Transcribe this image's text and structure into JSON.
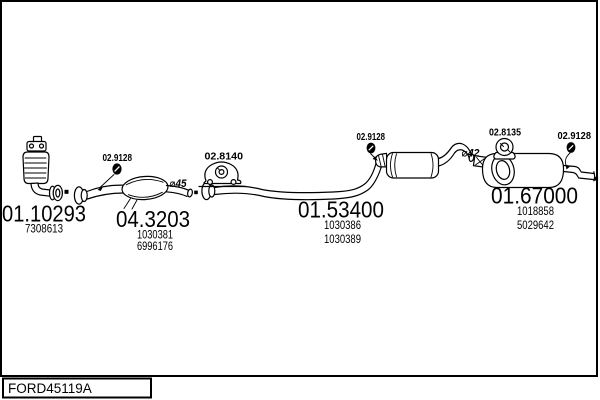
{
  "title": "Exhaust system diagram",
  "footer": {
    "catalog_code": "FORD45119A"
  },
  "parts": [
    {
      "id": "front-pipe-catalyst",
      "number": "01.10293",
      "oe_numbers": [
        "7308613"
      ]
    },
    {
      "id": "catalytic-converter",
      "number": "04.3203",
      "oe_numbers": [
        "1030381",
        "6996176"
      ]
    },
    {
      "id": "centre-exhaust-pipe",
      "number": "01.53400",
      "oe_numbers": [
        "1030386",
        "1030389"
      ]
    },
    {
      "id": "rear-silencer",
      "number": "01.67000",
      "oe_numbers": [
        "1018858",
        "5029642"
      ]
    }
  ],
  "accessories": [
    {
      "id": "clamp-left",
      "number": "02.9128",
      "type": "clamp"
    },
    {
      "id": "hanger-centre",
      "number": "02.8140",
      "type": "rubber-hanger"
    },
    {
      "id": "clamp-middle",
      "number": "02.9128",
      "type": "clamp"
    },
    {
      "id": "hanger-rear",
      "number": "02.8135",
      "type": "rubber-hanger"
    },
    {
      "id": "clamp-rear",
      "number": "02.9128",
      "type": "clamp"
    }
  ],
  "annotations": {
    "dia45": "⌀45",
    "dia42": "⌀42"
  },
  "colors": {
    "ink": "#000000",
    "background": "#ffffff"
  }
}
